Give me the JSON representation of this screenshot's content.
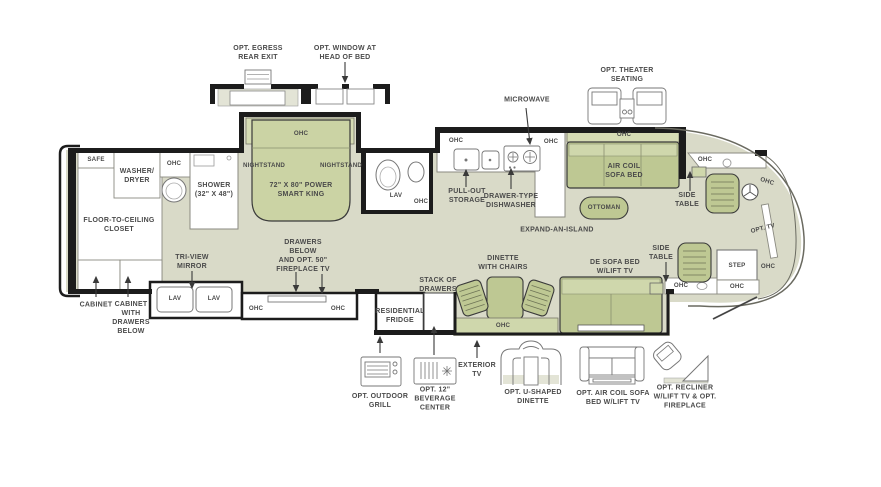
{
  "title": "RV Floorplan Diagram",
  "colors": {
    "floor": "#d9dac8",
    "furniture": "#bec893",
    "furniture_light": "#cfd7ac",
    "ohc_strip": "#d6dcb4",
    "wall": "#1c1c1c",
    "text": "#4a4a4a",
    "white": "#ffffff"
  },
  "labels": {
    "egress": "OPT. EGRESS\nREAR EXIT",
    "window_head": "OPT. WINDOW AT\nHEAD OF BED",
    "microwave": "MICROWAVE",
    "theater": "OPT. THEATER\nSEATING",
    "safe": "SAFE",
    "washer_dryer": "WASHER/\nDRYER",
    "closet": "FLOOR-TO-CEILING\nCLOSET",
    "cabinet": "CABINET",
    "cabinet_drawers": "CABINET\nWITH\nDRAWERS\nBELOW",
    "ohc_rear_bath": "OHC",
    "shower": "SHOWER\n(32\" X 48\")",
    "nightstand_left": "NIGHTSTAND",
    "ohc_bed": "OHC",
    "nightstand_right": "NIGHTSTAND",
    "bed": "72\" X 80\" POWER\nSMART KING",
    "tri_view": "TRI-VIEW\nMIRROR",
    "lav_vanity_left": "LAV",
    "lav_vanity_right": "LAV",
    "ohc_vanity_left": "OHC",
    "ohc_vanity_right": "OHC",
    "drawers_fireplace": "DRAWERS\nBELOW\nAND OPT. 50\"\nFIREPLACE TV",
    "lav_bath": "LAV",
    "ohc_bath": "OHC",
    "ohc_kitchen_left": "OHC",
    "ohc_kitchen_right": "OHC",
    "pull_out": "PULL-OUT\nSTORAGE",
    "dishwasher": "DRAWER-TYPE\nDISHWASHER",
    "ohc_sofa": "OHC",
    "air_coil_sofa": "AIR COIL\nSOFA BED",
    "ottoman": "OTTOMAN",
    "expand_island": "EXPAND-AN-ISLAND",
    "dinette": "DINETTE\nWITH CHAIRS",
    "de_sofa": "DE SOFA BED\nW/LIFT TV",
    "stack_drawers": "STACK OF\nDRAWERS",
    "fridge": "RESIDENTIAL\nFRIDGE",
    "ohc_dinette": "OHC",
    "side_table_top": "SIDE\nTABLE",
    "ohc_cockpit_top": "OHC",
    "ohc_windshield": "OHC",
    "opt_tv": "OPT. TV",
    "side_table_bottom": "SIDE\nTABLE",
    "step": "STEP",
    "ohc_step_right": "OHC",
    "ohc_entry": "OHC",
    "ohc_entry_left": "OHC",
    "exterior_tv": "EXTERIOR\nTV",
    "outdoor_grill": "OPT. OUTDOOR\nGRILL",
    "beverage": "OPT. 12\"\nBEVERAGE\nCENTER",
    "u_dinette": "OPT. U-SHAPED\nDINETTE",
    "opt_air_coil": "OPT. AIR COIL SOFA\nBED W/LIFT TV",
    "recliner": "OPT. RECLINER\nW/LIFT TV & OPT.\nFIREPLACE"
  }
}
